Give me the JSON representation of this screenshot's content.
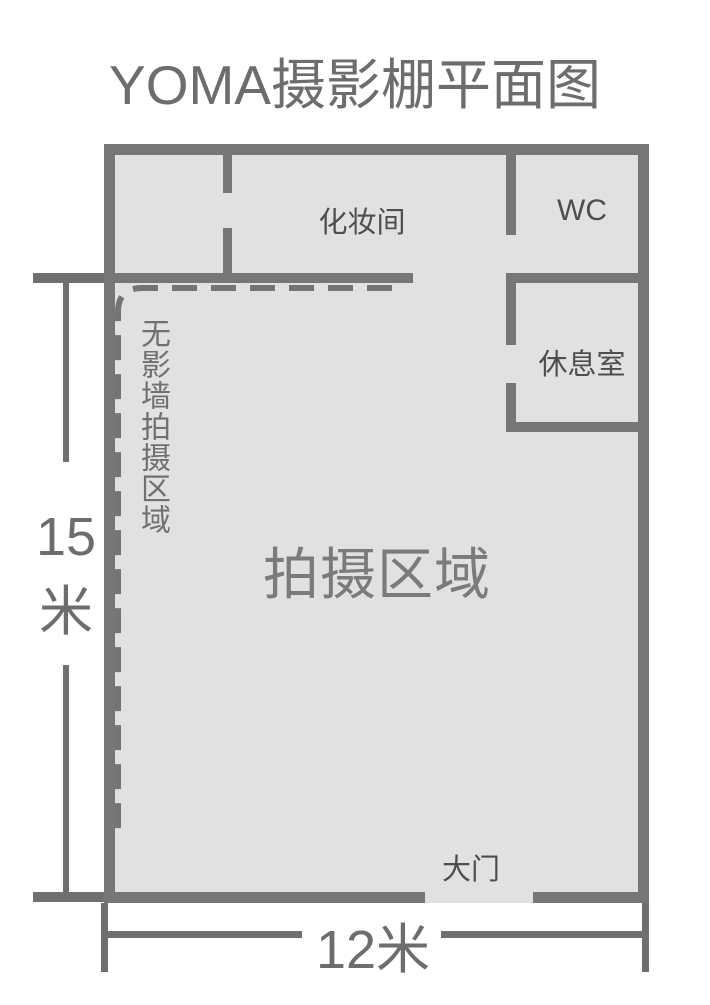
{
  "title": "YOMA摄影棚平面图",
  "colors": {
    "wall": "#767676",
    "floor_fill": "#e1e1e1",
    "room_label": "#4e4e4e",
    "shooting_area_label": "#7b7b7b",
    "dimension": "#6d6d6d",
    "background": "#ffffff"
  },
  "rooms": {
    "makeup": {
      "label": "化妆间"
    },
    "wc": {
      "label": "WC"
    },
    "lounge": {
      "label": "休息室"
    },
    "shadowless": {
      "label": "无影墙拍摄区域"
    },
    "shooting": {
      "label": "拍摄区域"
    },
    "door": {
      "label": "大门"
    }
  },
  "dimensions": {
    "height": {
      "value": "15",
      "unit": "米"
    },
    "width": {
      "label": "12米"
    }
  }
}
